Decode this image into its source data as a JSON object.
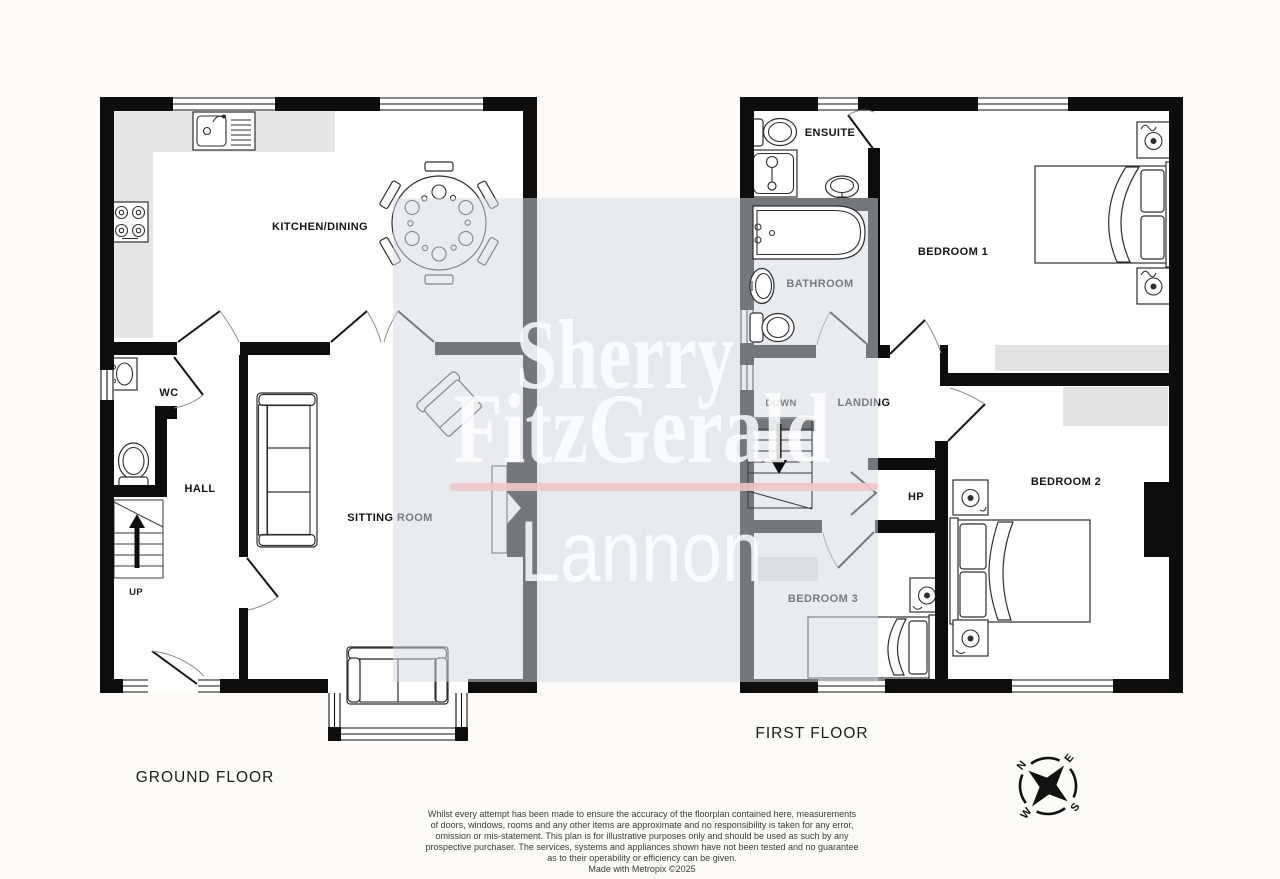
{
  "ground_floor": {
    "label": "GROUND FLOOR",
    "stairs_label": "UP",
    "rooms": {
      "kitchen_dining": "KITCHEN/DINING",
      "sitting_room": "SITTING ROOM",
      "hall": "HALL",
      "wc": "WC"
    }
  },
  "first_floor": {
    "label": "FIRST FLOOR",
    "stairs_label": "DOWN",
    "rooms": {
      "ensuite": "ENSUITE",
      "bathroom": "BATHROOM",
      "bedroom1": "BEDROOM 1",
      "bedroom2": "BEDROOM 2",
      "bedroom3": "BEDROOM 3",
      "landing": "LANDING",
      "hot_press": "HP"
    }
  },
  "watermark": {
    "line1": "Sherry",
    "line2": "FitzGerald",
    "line3": "Lannon",
    "underline_color": "#f1c7c9",
    "overlay_color": "#d2d9e3"
  },
  "compass": {
    "n": "N",
    "e": "E",
    "s": "S",
    "w": "W"
  },
  "disclaimer": {
    "lines": [
      "Whilst every attempt has been made to ensure the accuracy of the floorplan contained here, measurements",
      "of doors, windows, rooms and any other items are approximate and no responsibility is taken for any error,",
      "omission or mis-statement. This plan is for illustrative purposes only and should be used as such by any",
      "prospective purchaser. The services, systems and appliances shown have not been tested and no guarantee",
      "as to their operability or efficiency can be given.",
      "Made with Metropix ©2025"
    ]
  },
  "colors": {
    "wall": "#0d0d0d",
    "background": "#fbfaf8",
    "counter": "#e6e6e6"
  }
}
